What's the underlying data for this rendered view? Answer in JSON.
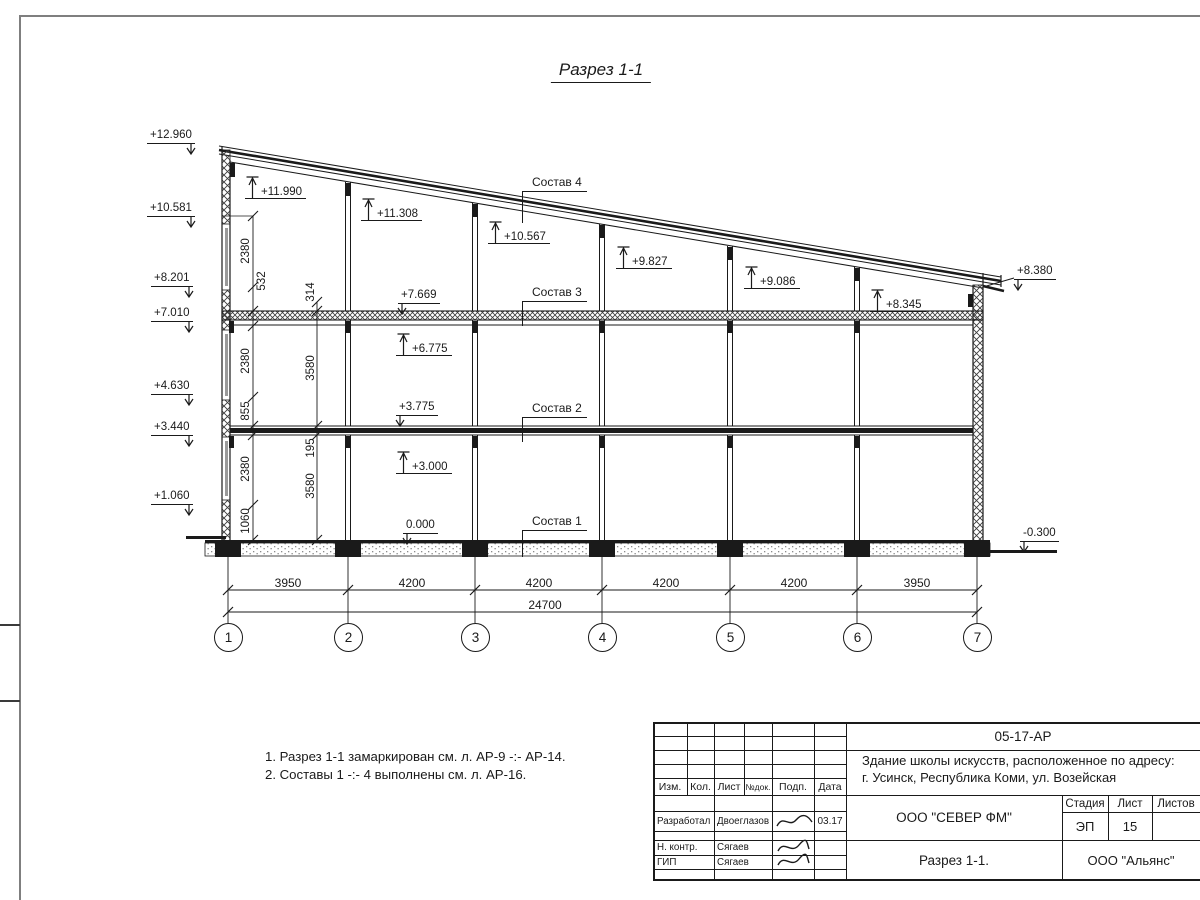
{
  "sheet": {
    "title": "Разрез 1-1"
  },
  "colors": {
    "ink": "#1a1a1a",
    "frame_gray": "#7f7f7f"
  },
  "notes": [
    "1. Разрез 1-1 замаркирован см. л. АР-9 -:- АР-14.",
    "2. Составы 1 -:- 4 выполнены см. л. АР-16."
  ],
  "levels": [
    {
      "label": "+12.960",
      "x": 147,
      "y": 129,
      "type": "flag-right"
    },
    {
      "label": "+10.581",
      "x": 147,
      "y": 202,
      "type": "flag-right"
    },
    {
      "label": "+8.201",
      "x": 151,
      "y": 272,
      "type": "flag-right"
    },
    {
      "label": "+7.010",
      "x": 151,
      "y": 307,
      "type": "flag-right"
    },
    {
      "label": "+4.630",
      "x": 151,
      "y": 380,
      "type": "flag-right"
    },
    {
      "label": "+3.440",
      "x": 151,
      "y": 421,
      "type": "flag-right"
    },
    {
      "label": "+1.060",
      "x": 151,
      "y": 490,
      "type": "flag-right"
    },
    {
      "label": "+11.990",
      "x": 252,
      "y": 176,
      "type": "up"
    },
    {
      "label": "+11.308",
      "x": 368,
      "y": 198,
      "type": "up"
    },
    {
      "label": "+10.567",
      "x": 495,
      "y": 221,
      "type": "up"
    },
    {
      "label": "+9.827",
      "x": 623,
      "y": 246,
      "type": "up"
    },
    {
      "label": "+9.086",
      "x": 751,
      "y": 266,
      "type": "up"
    },
    {
      "label": "+8.345",
      "x": 877,
      "y": 289,
      "type": "up"
    },
    {
      "label": "+6.775",
      "x": 403,
      "y": 333,
      "type": "up"
    },
    {
      "label": "+3.000",
      "x": 403,
      "y": 451,
      "type": "up"
    },
    {
      "label": "+7.669",
      "x": 398,
      "y": 289,
      "type": "flag-left"
    },
    {
      "label": "+3.775",
      "x": 396,
      "y": 401,
      "type": "flag-left"
    },
    {
      "label": "0.000",
      "x": 403,
      "y": 519,
      "type": "flag-left"
    },
    {
      "label": "+8.380",
      "x": 1014,
      "y": 265,
      "type": "flag-left"
    },
    {
      "label": "-0.300",
      "x": 1020,
      "y": 527,
      "type": "flag-left"
    }
  ],
  "compositions": [
    {
      "label": "Состав 4",
      "x": 522,
      "y": 175,
      "drop": 32
    },
    {
      "label": "Состав 3",
      "x": 522,
      "y": 285,
      "drop": 25
    },
    {
      "label": "Состав 2",
      "x": 522,
      "y": 401,
      "drop": 25
    },
    {
      "label": "Состав 1",
      "x": 522,
      "y": 514,
      "drop": 27
    }
  ],
  "vertical_dims": [
    {
      "label": "2380",
      "x": 246,
      "y": 251
    },
    {
      "label": "532",
      "x": 262,
      "y": 281
    },
    {
      "label": "2380",
      "x": 246,
      "y": 361
    },
    {
      "label": "855",
      "x": 246,
      "y": 411
    },
    {
      "label": "2380",
      "x": 246,
      "y": 469
    },
    {
      "label": "1060",
      "x": 246,
      "y": 521
    },
    {
      "label": "314",
      "x": 311,
      "y": 292
    },
    {
      "label": "3580",
      "x": 311,
      "y": 368
    },
    {
      "label": "195",
      "x": 311,
      "y": 448
    },
    {
      "label": "3580",
      "x": 311,
      "y": 486
    }
  ],
  "axis_bubbles": [
    {
      "label": "1",
      "x": 228
    },
    {
      "label": "2",
      "x": 348
    },
    {
      "label": "3",
      "x": 475
    },
    {
      "label": "4",
      "x": 602
    },
    {
      "label": "5",
      "x": 730
    },
    {
      "label": "6",
      "x": 857
    },
    {
      "label": "7",
      "x": 977
    }
  ],
  "bottom_dims": {
    "segments": [
      {
        "label": "3950",
        "cx": 288
      },
      {
        "label": "4200",
        "cx": 412
      },
      {
        "label": "4200",
        "cx": 539
      },
      {
        "label": "4200",
        "cx": 666
      },
      {
        "label": "4200",
        "cx": 794
      },
      {
        "label": "3950",
        "cx": 917
      }
    ],
    "total": {
      "label": "24700",
      "cx": 545
    }
  },
  "titleblock": {
    "code": "05-17-АР",
    "project_line1": "Здание школы искусств, расположенное по адресу:",
    "project_line2": "г. Усинск, Республика Коми, ул. Возейская",
    "cols": {
      "izm": "Изм.",
      "kol": "Кол.",
      "list": "Лист",
      "ndok": "№док.",
      "podp": "Подп.",
      "data": "Дата"
    },
    "rows": [
      {
        "role": "Разработал",
        "name": "Двоеглазов",
        "date": "03.17"
      },
      {
        "role": "Н. контр.",
        "name": "Сягаев",
        "date": ""
      },
      {
        "role": "ГИП",
        "name": "Сягаев",
        "date": ""
      }
    ],
    "org": "ООО \"СЕВЕР ФМ\"",
    "stage_label": "Стадия",
    "sheet_label": "Лист",
    "sheets_label": "Листов",
    "stage": "ЭП",
    "sheet_no": "15",
    "sheets_total": "",
    "sheet_title": "Разрез 1-1.",
    "company": "ООО \"Альянс\""
  }
}
